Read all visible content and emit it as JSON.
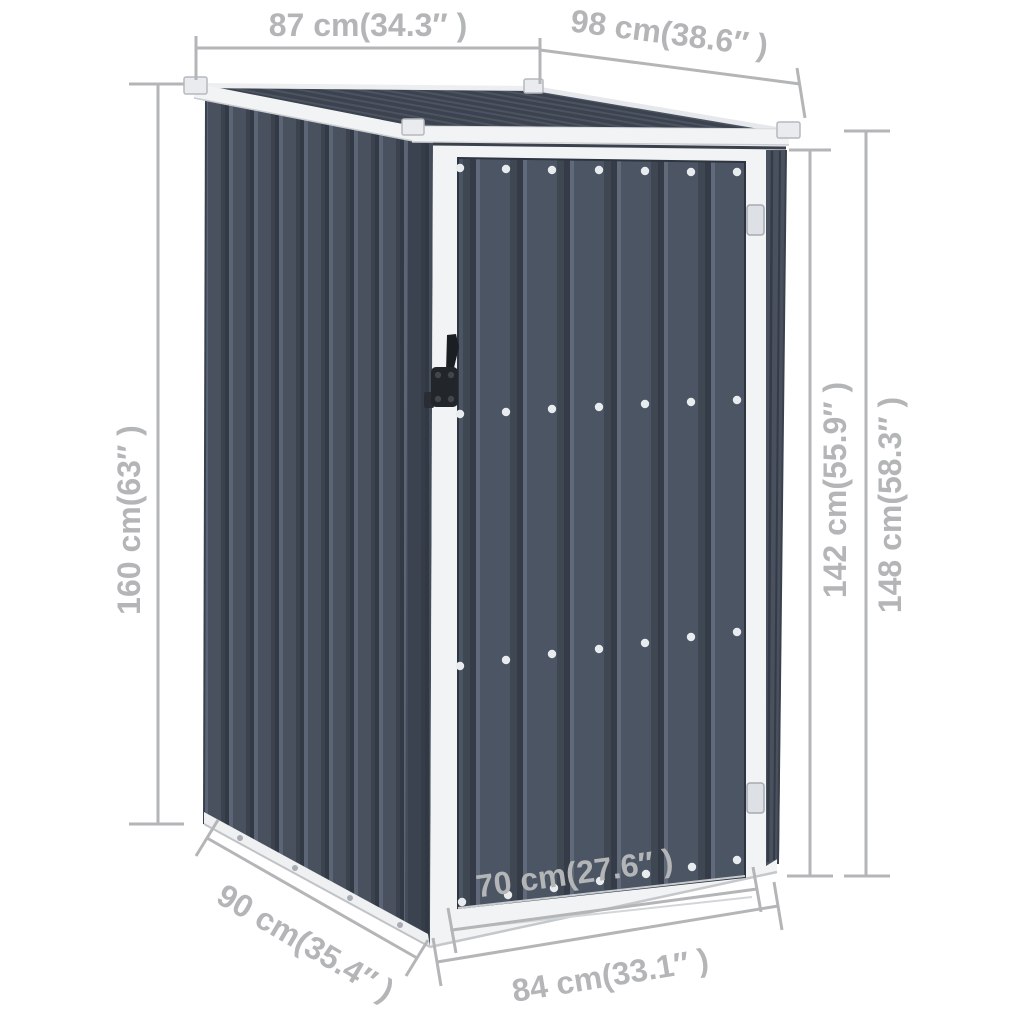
{
  "image": {
    "title": "Garden shed product dimension diagram",
    "subject": "metal garden shed with single door, corrugated panels, white trim",
    "body_color_name": "anthracite"
  },
  "dimension_labels": {
    "roof_depth_top_left": "87 cm(34.3″ )",
    "roof_width_top_right": "98 cm(38.6″ )",
    "height_back_left": "160 cm(63″ )",
    "height_front_inner_right": "142 cm(55.9″ )",
    "height_front_outer_right": "148 cm(58.3″ )",
    "base_depth_bottom_left": "90 cm(35.4″ )",
    "door_width_bottom_center": "70 cm(27.6″ )",
    "base_width_bottom": "84 cm(33.1″ )"
  },
  "colors": {
    "background": "#ffffff",
    "shed-dark": "#49515f",
    "shed-darker": "#3c434f",
    "frame-white": "#f2f3f5",
    "dim-gray": "#b3b5b7"
  }
}
